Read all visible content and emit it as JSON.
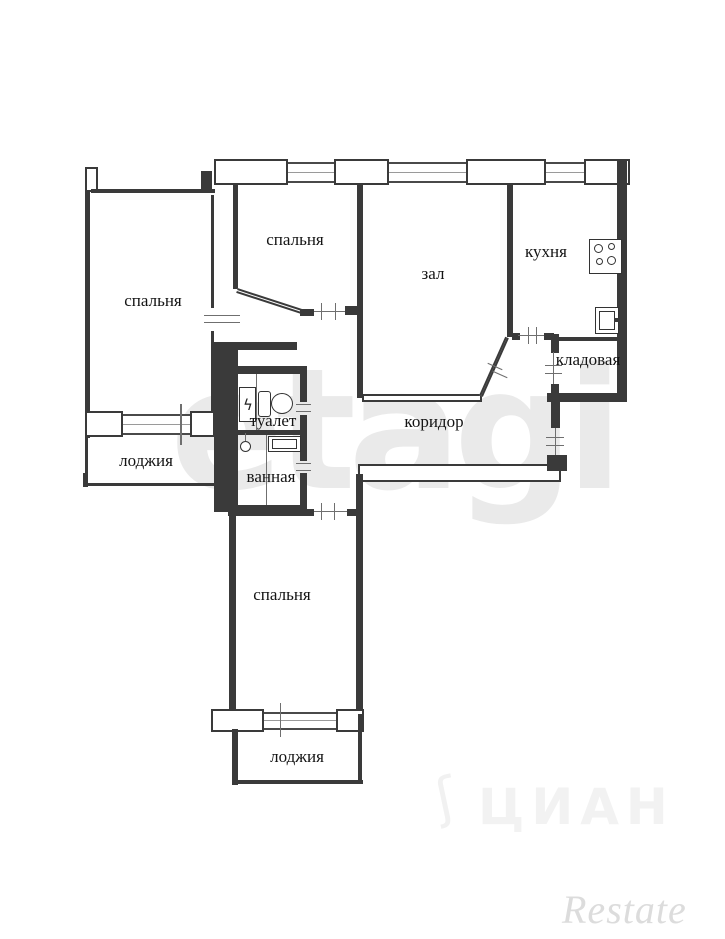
{
  "plan": {
    "type": "apartment-floor-plan",
    "rooms": {
      "bedroom_top_left": {
        "label": "спальня"
      },
      "bedroom_top_middle": {
        "label": "спальня"
      },
      "hall": {
        "label": "зал"
      },
      "kitchen": {
        "label": "кухня"
      },
      "storage": {
        "label": "кладовая"
      },
      "corridor": {
        "label": "коридор"
      },
      "toilet": {
        "label": "туалет"
      },
      "bathroom": {
        "label": "ванная"
      },
      "loggia_left": {
        "label": "лоджия"
      },
      "bedroom_bottom": {
        "label": "спальня"
      },
      "loggia_bottom": {
        "label": "лоджия"
      }
    },
    "fixtures": [
      "stove-icon",
      "kitchen-sink-icon",
      "toilet-icon",
      "electric-panel-icon",
      "washbasin-icon",
      "bathtub-icon"
    ],
    "symbols": {
      "electric_panel": "ϟ"
    },
    "colors": {
      "wall": "#3a3a3a",
      "background": "#ffffff",
      "watermark_light": "#eaeaea"
    }
  },
  "watermarks": {
    "center": "etagi",
    "bottom_center": "ЦИАН",
    "bottom_center_bird": "ʃ",
    "bottom_right": "Restate"
  }
}
